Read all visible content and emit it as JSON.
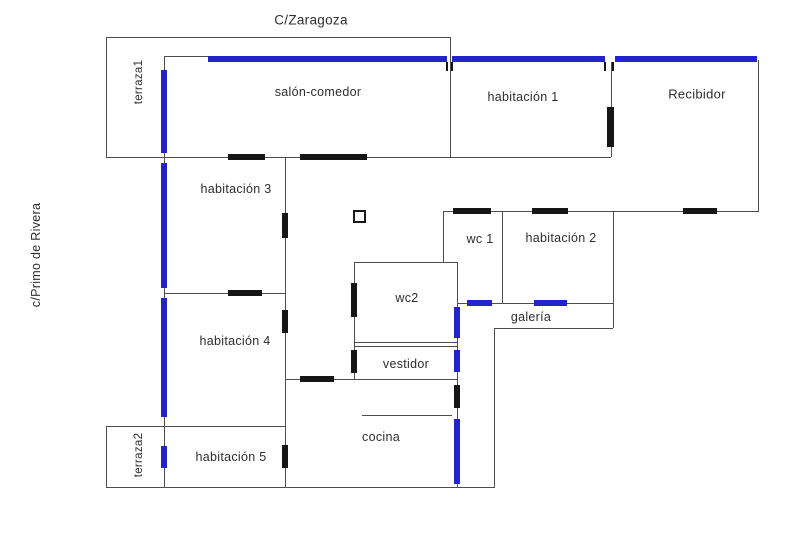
{
  "colors": {
    "window_blue": "#2323cd",
    "wall_gray": "#4d4d4d",
    "door_black": "#161616",
    "text_dark": "#2e2e2e",
    "background": "#ffffff"
  },
  "streets": {
    "top": "C/Zaragoza",
    "left": "c/Primo de Rivera"
  },
  "rooms": {
    "terraza1": "terraza1",
    "salon_comedor": "salón-comedor",
    "habitacion1": "habitación 1",
    "recibidor": "Recibidor",
    "habitacion3": "habitación 3",
    "wc1": "wc 1",
    "habitacion2": "habitación 2",
    "wc2": "wc2",
    "galeria": "galería",
    "habitacion4": "habitación 4",
    "vestidor": "vestidor",
    "cocina": "cocina",
    "habitacion5": "habitación 5",
    "terraza2": "terraza2"
  },
  "legend": {
    "window_marker": "window (blue)",
    "door_marker": "door (black)"
  }
}
